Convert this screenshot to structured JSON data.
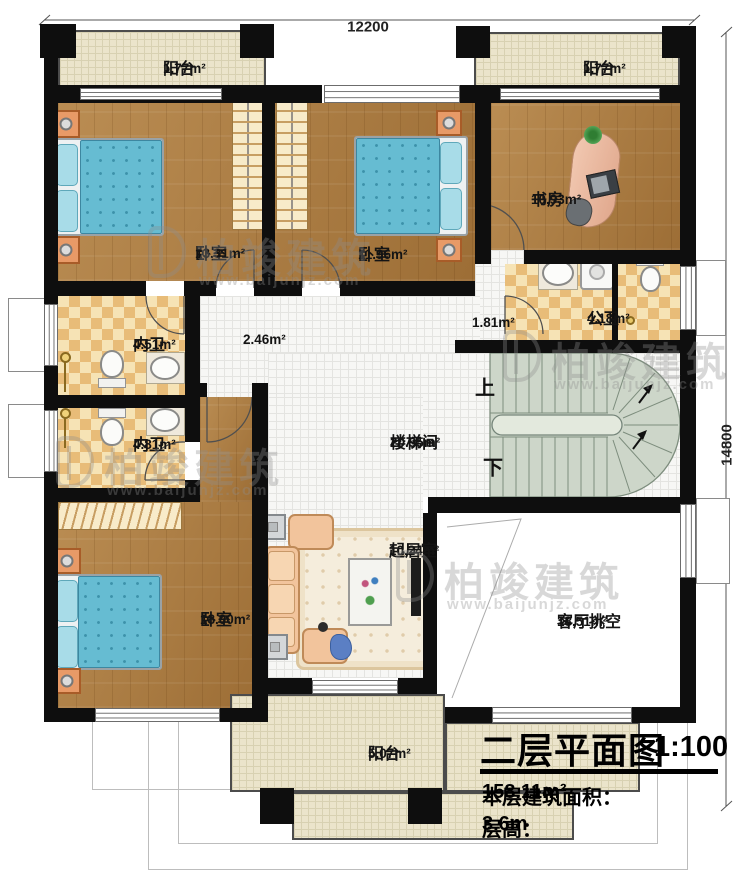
{
  "plan": {
    "dimensions": {
      "top": "12200",
      "right": "14800"
    },
    "stairs": {
      "up": "上",
      "down": "下"
    },
    "rooms": {
      "balcony_tl": {
        "name": "阳台",
        "area": "1.77m²"
      },
      "balcony_tr": {
        "name": "阳台",
        "area": "1.77m²"
      },
      "bedroom_tl": {
        "name": "卧室",
        "area": "13.31m²"
      },
      "bedroom_tm": {
        "name": "卧室",
        "area": "11.96m²"
      },
      "study": {
        "name": "书房",
        "area": "10.93m²"
      },
      "public_bath": {
        "name": "公卫",
        "area": "4.18m²"
      },
      "hall_niche": {
        "area": "1.81m²"
      },
      "ensuite_top": {
        "name": "内卫",
        "area": "4.51m²"
      },
      "ensuite_bottom": {
        "name": "内卫",
        "area": "4.81m²"
      },
      "corridor": {
        "area": "2.46m²"
      },
      "stair_hall": {
        "name": "楼梯间",
        "area": "20.95m²"
      },
      "bedroom_b": {
        "name": "卧室",
        "area": "18.00m²"
      },
      "sitting": {
        "name": "起居室",
        "area": "10.24m²"
      },
      "void": {
        "name": "客厅挑空",
        "area": "18.51m²"
      },
      "balcony_b": {
        "name": "阳台",
        "area": "5.07m²"
      }
    }
  },
  "title_block": {
    "title": "二层平面图",
    "scale": "1:100",
    "area_label": "本层建筑面积：",
    "area_value": "158.11m²",
    "floor_height_label": "层高：",
    "floor_height_value": "3.6m"
  },
  "watermark": {
    "brand": "柏竣建筑",
    "url": "www.baijunjz.com"
  },
  "colors": {
    "wall": "#0e0e0e",
    "wood": "#af7d40",
    "bath_tile": "#e8bc78",
    "balcony": "#ebe4cb",
    "stair": "#cdd6c9",
    "bed": "#66bcd2"
  }
}
